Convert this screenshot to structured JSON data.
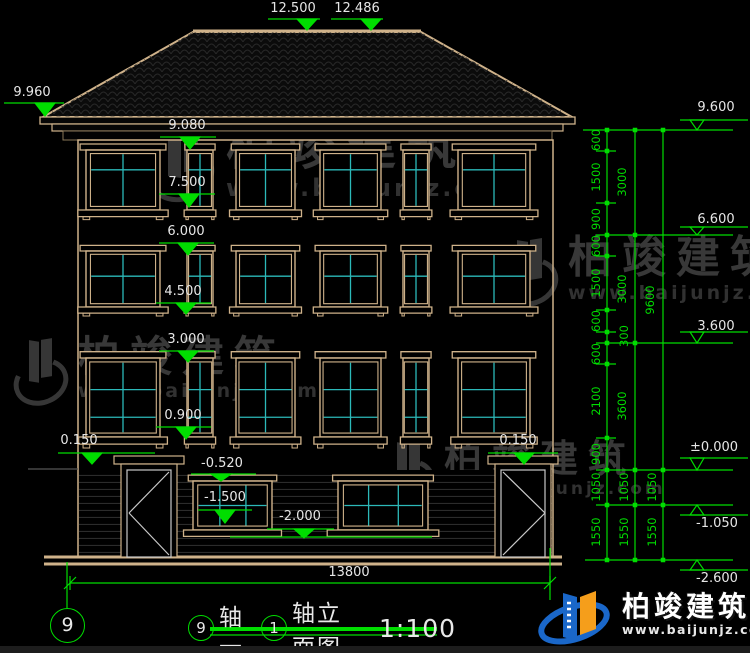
{
  "colors": {
    "background": "#000000",
    "dimension_green": "#00dd00",
    "structure_tan": "#cfb28a",
    "glazing_cyan": "#2cb9b9",
    "text_white": "#e6e6e6",
    "watermark_gray": "#383838",
    "logo_blue": "#1a67c9",
    "logo_orange": "#f59e1b"
  },
  "levels": {
    "roof_peak": "12.500",
    "roof_peak2": "12.486",
    "eave_left": "9.960",
    "win3_top": "9.080",
    "win3_sill": "7.500",
    "win2_top": "6.000",
    "win2_sill": "4.500",
    "win1_top": "3.000",
    "win1_sill": "0.900",
    "door_left_top": "0.150",
    "door_right_top": "0.150",
    "bw_top": "-0.520",
    "bw_mid": "-1.500",
    "bw_bottom": "-2.000",
    "right_eave": "9.600",
    "floor3": "6.600",
    "floor2": "3.600",
    "ground": "±0.000",
    "site": "-1.050",
    "foundation": "-2.600"
  },
  "dims": {
    "col1": [
      "600",
      "1500",
      "900",
      "600",
      "1500",
      "600",
      "300",
      "600",
      "2100",
      "900"
    ],
    "col2": [
      "3000",
      "3000",
      "3600"
    ],
    "total": "9600",
    "sub": [
      "1050",
      "1050",
      "1050",
      "1550",
      "1550",
      "1550"
    ],
    "width": "13800"
  },
  "title": {
    "bubble_left": "9",
    "seg1": "轴—",
    "bubble_right": "1",
    "seg2": "轴立面图",
    "scale": "1:100"
  },
  "axis": {
    "bubble": "9"
  },
  "watermark": {
    "name": "柏竣建筑",
    "url": "www.baijunjz.com"
  },
  "logo": {
    "name": "柏竣建筑",
    "url": "www.baijunjz.com"
  }
}
